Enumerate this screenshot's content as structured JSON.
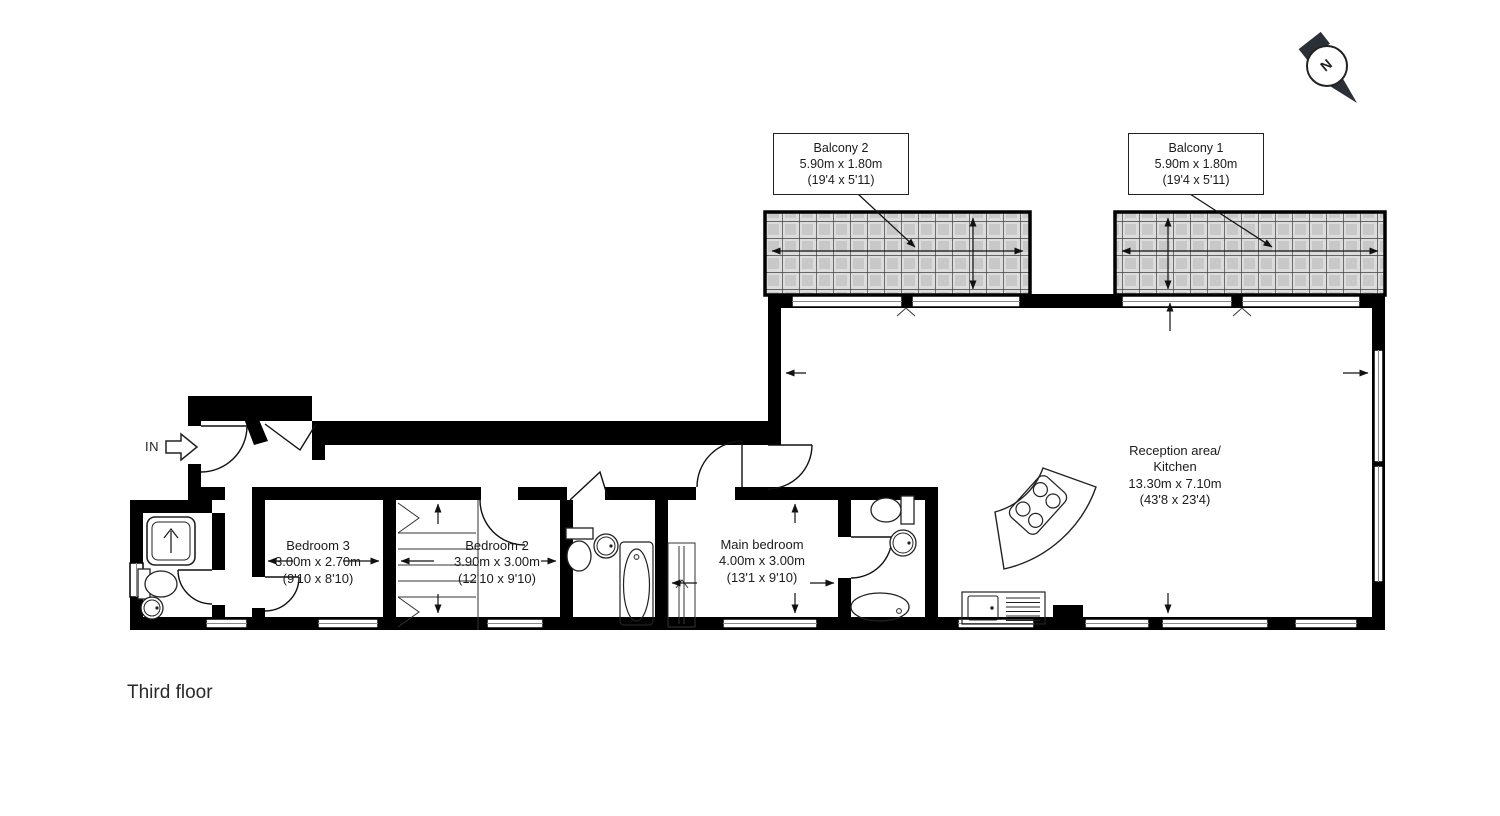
{
  "floor_label": "Third floor",
  "compass": {
    "label": "N"
  },
  "entrance": {
    "label": "IN"
  },
  "balconies": [
    {
      "name": "Balcony 2",
      "dims_metric": "5.90m x 1.80m",
      "dims_imperial": "(19'4 x 5'11)"
    },
    {
      "name": "Balcony 1",
      "dims_metric": "5.90m x 1.80m",
      "dims_imperial": "(19'4 x 5'11)"
    }
  ],
  "rooms": [
    {
      "name": "Bedroom 3",
      "dims_metric": "3.00m x 2.70m",
      "dims_imperial": "(9'10 x 8'10)"
    },
    {
      "name": "Bedroom 2",
      "dims_metric": "3.90m x 3.00m",
      "dims_imperial": "(12'10 x 9'10)"
    },
    {
      "name": "Main bedroom",
      "dims_metric": "4.00m x 3.00m",
      "dims_imperial": "(13'1 x 9'10)"
    },
    {
      "name": "Reception area/",
      "name_line2": "Kitchen",
      "dims_metric": "13.30m x 7.10m",
      "dims_imperial": "(43'8 x 23'4)"
    }
  ],
  "colors": {
    "wall": "#000000",
    "balcony_tile": "#d6d6d6",
    "balcony_grid": "#3f3f3f",
    "text": "#1b1b1b"
  }
}
